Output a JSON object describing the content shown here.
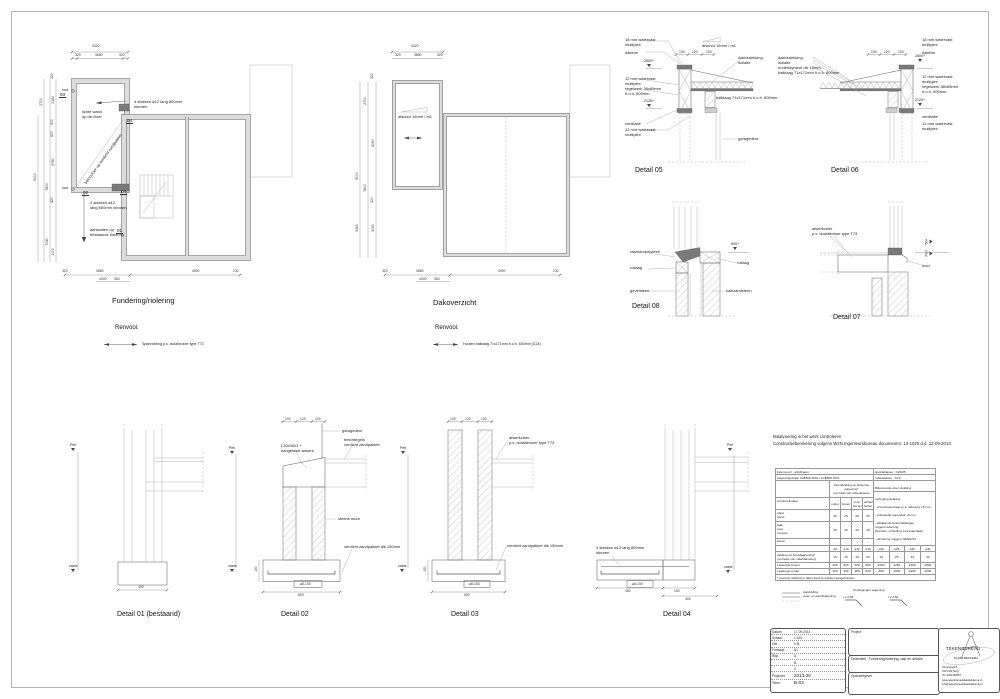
{
  "plans": {
    "fundering": {
      "title": "Fundering/riolering",
      "renvooi_label": "Renvooi:",
      "renvooi_item": "Spanrichting p.s. isolatievloer type T73",
      "dims_top": [
        "4320",
        "320",
        "3680",
        "320"
      ],
      "dims_left": [
        "320",
        "2180",
        "2700",
        "500",
        "600",
        "5780",
        "420",
        "1000",
        "7800",
        "9000",
        "7040"
      ],
      "hwa": "hwa",
      "dims_bottom": [
        "320",
        "3680",
        "4000",
        "350",
        "4900",
        "230"
      ],
      "ann_stekken_top": "4 stekken ø12 lang 800mm\ninboren",
      "ann_lichte_wand": "lichte wand\nop de vloer",
      "ann_betonvloer": "betonvloer op verdicht zandpakket",
      "ann_stekken_bottom": "4 stekken ø12\nlang 800mm inboren",
      "ann_riolering": "aansluiten op\nbestaande riolering",
      "ref01": "01",
      "ref02": "02",
      "ref03": "03",
      "ref04": "04"
    },
    "dak": {
      "title": "Dakoverzicht",
      "renvooi_label": "Renvooi:",
      "renvooi_item": "Houten balklaag 71x171mm h.o.h. 600mm (C24)",
      "ann_afschot": "afschot 16mm / m1",
      "dims_top": [
        "4320",
        "320",
        "3680",
        "320"
      ],
      "dims_left": [
        "320",
        "2700",
        "8060",
        "9000",
        "7800",
        "320",
        "5360",
        "5060"
      ],
      "dims_bottom": [
        "320",
        "3680",
        "4000",
        "350",
        "4900",
        "230"
      ]
    }
  },
  "details": {
    "d05": {
      "title": "Detail 05",
      "multiplex18": "18 mm watervast\nmultiplex",
      "daktrim": "daktrim",
      "lvl_2600": "2600+",
      "multiplex12a": "12 mm watervast\nmultiplex",
      "regelwerk": "regelwerk 38x89mm\nh.o.h. 600mm",
      "lvl_2125": "2125+",
      "ventilatie": "ventilatie",
      "multiplex12b": "12 mm watervast\nmultiplex",
      "afschot": "afschot 16mm / m1",
      "dakbedekking": "dakbedekking\nisolatie",
      "balklaag": "balklaag 71x171mm h.o.h. 600mm",
      "garagedeur": "garagedeur",
      "dims": [
        "100",
        "120",
        "100"
      ]
    },
    "d06": {
      "title": "Detail 06",
      "stack": "dakbedekking\nisolatie\nunderlayment dik 18mm\nbalklaag 71x171mm h.o.h. 600mm",
      "multiplex18": "18 mm watervast\nmultiplex",
      "daktrim": "daktrim",
      "lvl_2600": "2600+",
      "multiplex12a": "12 mm watervast\nmultiplex",
      "regelwerk": "regelwerk 38x89mm\nh.o.h. 600mm",
      "lvl_2125": "2125+",
      "ventilatie": "ventilatie",
      "multiplex12b": "12 mm watervast\nmultiplex",
      "dims": [
        "100",
        "120",
        "100"
      ]
    },
    "d08": {
      "title": "Detail 08",
      "raamdorpelsteen": "raamdorpelsteen",
      "rollaag_left": "rollaag",
      "gevelsteen": "gevelsteen",
      "lvl_900": "900+",
      "rollaag_right": "rollaag",
      "kalkzandsteen": "kalkzandsteen"
    },
    "d07": {
      "title": "Detail 07",
      "afwerkvloer": "afwerkvloer\np.s. isolatievloer type T73",
      "lvl_50": "50+",
      "peil": "Peil",
      "lood": "lood"
    },
    "d01": {
      "title": "Detail 01 (bestaand)",
      "peil": "Peil",
      "vaste": "vaste",
      "dim_breedte": "400"
    },
    "d02": {
      "title": "Detail 02",
      "dims": [
        "100",
        "120",
        "100"
      ],
      "garagedeur": "garagedeur",
      "betontegels": "betontegels\nverdicht zandpakket",
      "ankers": "L30x30x3 +\naangelaste ankers",
      "steens_muur": "steens muur",
      "zandpakket": "verdicht zandpakket dik 150mm",
      "rebar": "⌀8-150",
      "dim_breedte": "600",
      "dim_hoogte": "150",
      "peil": "Peil",
      "vaste": "vaste"
    },
    "d03": {
      "title": "Detail 03",
      "dims": [
        "100",
        "120",
        "100"
      ],
      "afwerkvloer": "afwerkvloer\np.s. isolatievloer type T73",
      "zandpakket": "verdicht zandpakket dik 150mm",
      "rebar": "⌀8-150",
      "dim_breedte": "600",
      "dim_hoogte": "150",
      "peil": "Peil",
      "vaste": "vaste"
    },
    "d04": {
      "title": "Detail 04",
      "stekken": "4 stekken ø12 lang 800mm\ninboren",
      "rebar": "⌀8-150",
      "dims": [
        "450",
        "150",
        "400"
      ],
      "peil": "Peil",
      "vaste": "vaste"
    }
  },
  "notes": {
    "line1": "Maatvoering in het werk controleren",
    "line2": "Constructieberekening volgens W2N Ingenieursbureau documentnr. 13-1020 d.d. 12-09-2013"
  },
  "ctable": {
    "betonsoort_label": "betonsoort:",
    "betonsoort": "grindbeton",
    "sterkte_label": "sterkteklasse :",
    "sterkte": "C20/25",
    "wapening_label": "wapeningsstaal:",
    "wapening": "FeB500 HWL / FeB500 HKN",
    "milieu_label": "milieuklasse :",
    "milieu": "XC2",
    "dekking_header": "betondekking op buitenste wapening*\n(op basis van milieuklasse)",
    "bijkomend_header": "Bijkomende eisen dekking",
    "col_deel": "constructiedeel",
    "cols": [
      "onder",
      "boven",
      "voor/\nbinnen",
      "achter/\nbuiten"
    ],
    "verhoging": "verhoging dekking",
    "bullets": [
      "- oncontroleerbaar (o.a. wtbeton)  +5 mm",
      "- onbewerkt oppervlak  +5 mm",
      "- afwijkende betondekkingen\n  volgens tekening\n  [bundels, omhulling voorspanstaal]",
      "- uitvoering volgens NEN6722"
    ],
    "rows": [
      {
        "name": "plaat\nwand",
        "v": [
          "25",
          "25",
          "25",
          "25"
        ]
      },
      {
        "name": "balk\npoer\nconsole",
        "v": [
          "30",
          "30",
          "30",
          "30"
        ]
      },
      {
        "name": "kolom",
        "v": [
          "-",
          "-",
          "-",
          "-"
        ]
      }
    ],
    "dia": [
      "⌀8",
      "⌀10",
      "⌀12",
      "⌀16",
      "⌀20",
      "⌀25",
      "⌀32",
      "⌀40"
    ],
    "hoofd_label": "dekking op hoofdwapening*\n(op basis van staafdiameter)",
    "hoofd": [
      "15",
      "15",
      "15",
      "20",
      "20",
      "25",
      "32",
      "40"
    ],
    "las_boven_label": "Laslengte boven",
    "las_boven": [
      "400",
      "500",
      "600",
      "800",
      "1000",
      "1250",
      "1600",
      "2000"
    ],
    "las_onder_label": "Laslengte onder",
    "las_onder": [
      "320",
      "400",
      "480",
      "640",
      "800",
      "1000",
      "1280",
      "1600"
    ],
    "footnote": "* grootste dekking in tabel dient te worden aangehouden",
    "aanduiding": "Aanduiding\nvloer- en wandwapening",
    "ombuiging": "Ombuigingen wapening",
    "radius1": "r ≥ 2,5d",
    "radius2": "r ≥ 2,5d"
  },
  "titleblock": {
    "datum_label": "Datum:",
    "datum": "17-09-2013",
    "schaal_label": "Schaal:",
    "schaal": "1:100",
    "get_label": "Get.:",
    "get": "K.B.",
    "formaat_label": "Formaat:",
    "formaat": "A1",
    "wijz_label": "Wijz.:",
    "wijz_a": "A",
    "wijz_b": "B",
    "wijz_c": "C",
    "projectnr_label": "Projectnr.:",
    "projectnr": "2013-20",
    "teknr_label": "Teknr.:",
    "teknr": "B-03",
    "project_label": "Project",
    "onderdeel_label": "Onderdeel",
    "onderdeel": "Fundering/riolering, dak en details",
    "opdrachtgever_label": "Opdrachtgever",
    "bureau": "TEKENBUREAU",
    "bureau_naam": "KLAAS BEKKEMA",
    "adres1": "Pompstraat 5",
    "adres2": "9331 AM Norg",
    "adres3": "Tel. 0631199507",
    "web": "www.tekenbureauklaasbekkema.nl",
    "email": "info@tekenbureauklaasbekkema.nl"
  }
}
